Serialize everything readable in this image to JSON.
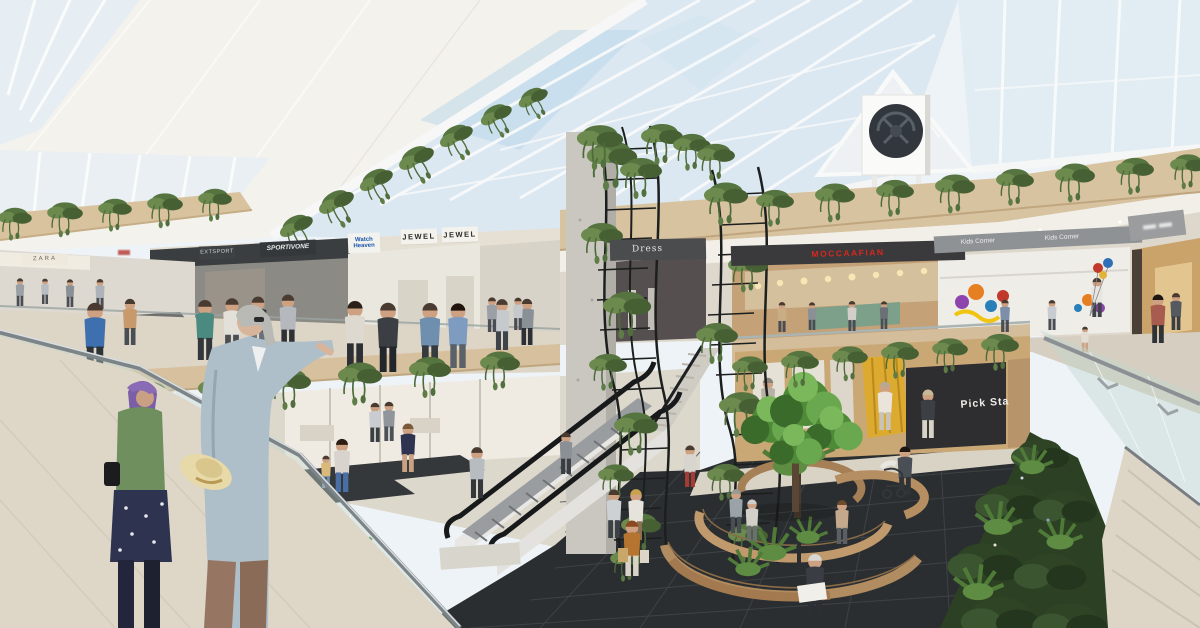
{
  "meta": {
    "title": "Shopping mall atrium — architectural rendering",
    "description": "Photorealistic visualization of a two-level shopping mall atrium with a gabled glass skylight roof, hanging greenery on wood-faced balconies, vertical garden trellises, crossing escalators, glass balustrades and a dark-tiled central plaza with curved wooden benches and shoppers."
  },
  "signs": {
    "zara": {
      "label": "ZARA"
    },
    "extsport": {
      "label": "EXTSPORT"
    },
    "sportivone": {
      "label": "SPORTIVONE"
    },
    "watch_heaven": {
      "label": "Watch Heaven",
      "color": "#1a56a8"
    },
    "jewel_a": {
      "label": "JEWEL"
    },
    "jewel_b": {
      "label": "JEWEL"
    },
    "dress": {
      "label": "Dress"
    },
    "moccaafian": {
      "label": "MOCCAAFIAN",
      "color": "#d8281e"
    },
    "kids_corner_a": {
      "label": "Kids Corner"
    },
    "kids_corner_b": {
      "label": "Kids Corner"
    },
    "pick_sta": {
      "label": "Pick Sta"
    }
  },
  "palette": {
    "sky_glass": "#dce8f1",
    "roof_frame": "#f6f7f6",
    "ceiling_white": "#f4f2ed",
    "wood_band": "#d8c3a0",
    "fascia_dark": "#3a3d40",
    "upper_floor": "#ddd5c6",
    "lower_floor_light": "#ddd8cc",
    "plaza_dark_tile": "#2b2e30",
    "greenery": "#4e6b3c",
    "bench_wood": "#b08c60",
    "glass_railing": "#c3d7d0"
  },
  "scene": {
    "elements": [
      "gabled glass skylight with white steel mullions",
      "white HVAC fan unit on skylight gable",
      "hanging plant garlands along balcony and roof edges",
      "two wavy black vertical-garden trellises with climbing vines",
      "concrete atrium pillar",
      "crossing escalators between levels",
      "curved wooden slat benches around a central tree and light pole",
      "man reading a newspaper on a bench",
      "elderly man with straw hat leaning on glass railing (foreground)",
      "woman with purple hair and polka-dot skirt (foreground)",
      "shoppers with bags, a child with balloons, a stroller",
      "lower-level fashion store with mannequins and yellow curtain",
      "dense fern hedge below right balcony"
    ]
  }
}
